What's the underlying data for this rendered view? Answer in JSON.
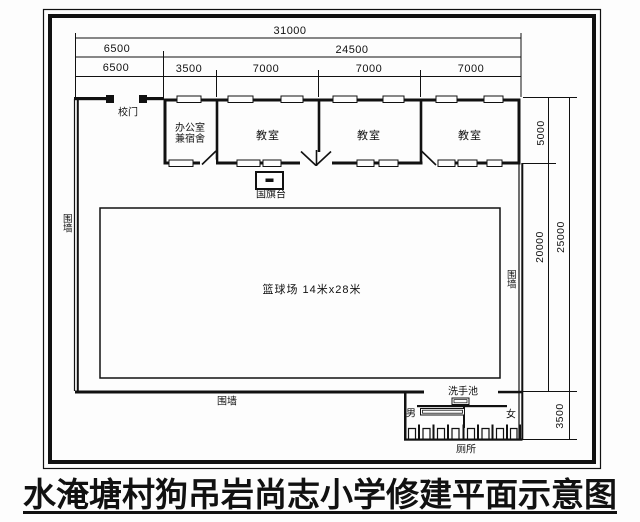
{
  "title": "水淹塘村狗吊岩尚志小学修建平面示意图",
  "dims": {
    "total_width": "31000",
    "entrance_width": "6500",
    "building_width": "24500",
    "entrance_width2": "6500",
    "office_width": "3500",
    "classroom1_width": "7000",
    "classroom2_width": "7000",
    "classroom3_width": "7000",
    "building_depth": "5000",
    "yard_depth": "20000",
    "site_depth": "25000",
    "toilet_depth": "3500"
  },
  "labels": {
    "gate": "校门",
    "office": "办公室\n兼宿舍",
    "classrooms": [
      "教室",
      "教室",
      "教室"
    ],
    "flag_stand": "国旗台",
    "court": "篮球场 14米x28米",
    "wall_left": "围墙",
    "wall_right": "围墙",
    "wall_bottom": "围墙",
    "washbasin": "洗手池",
    "men": "男",
    "women": "女",
    "toilet": "厕所"
  },
  "colors": {
    "ink": "#111111",
    "paper": "#fdfdfd"
  }
}
